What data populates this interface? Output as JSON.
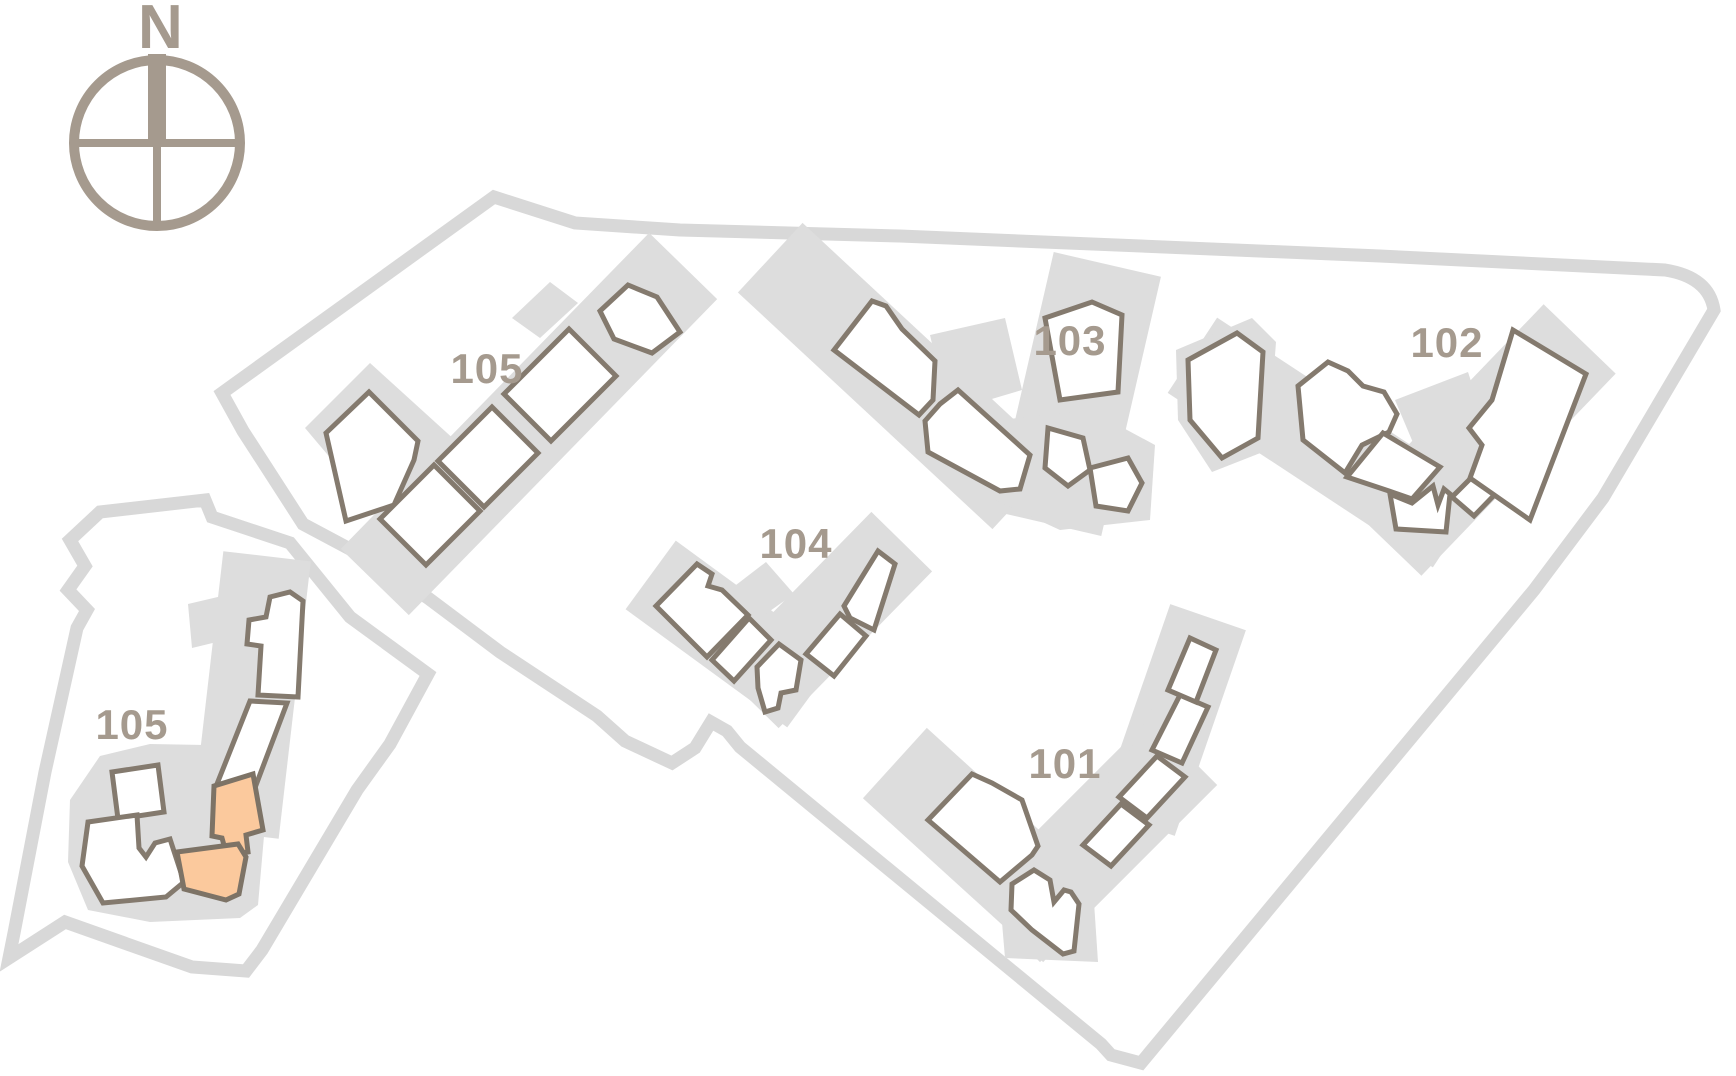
{
  "compass": {
    "label": "N"
  },
  "buildings": [
    {
      "id": "building-105-upper",
      "label": "105",
      "highlighted_units": 0
    },
    {
      "id": "building-103",
      "label": "103",
      "highlighted_units": 0
    },
    {
      "id": "building-102",
      "label": "102",
      "highlighted_units": 0
    },
    {
      "id": "building-104",
      "label": "104",
      "highlighted_units": 0
    },
    {
      "id": "building-101",
      "label": "101",
      "highlighted_units": 0
    },
    {
      "id": "building-105-lower",
      "label": "105",
      "highlighted_units": 2
    }
  ],
  "colors": {
    "background": "#ffffff",
    "site_boundary": "#d8d8d8",
    "building_plinth": "#dddddd",
    "unit_fill": "#ffffff",
    "unit_stroke": "#847a6e",
    "unit_highlight": "#fbc99d",
    "label_text": "#a59a8e",
    "compass": "#a59a8e"
  }
}
